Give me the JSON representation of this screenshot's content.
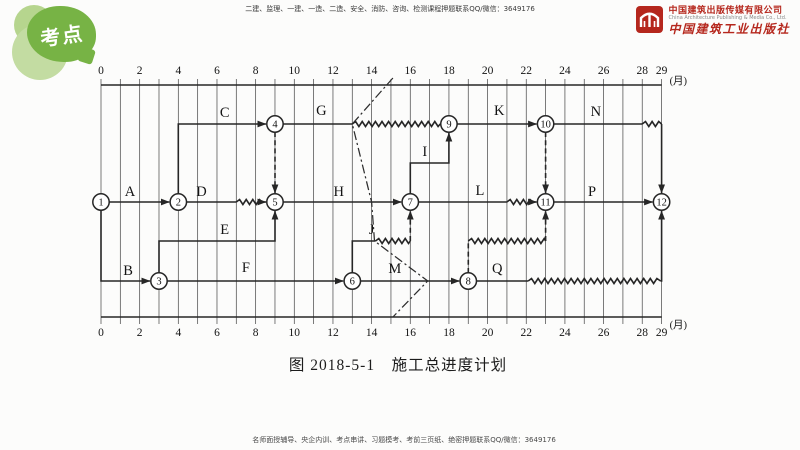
{
  "badge": {
    "text": "考点",
    "color": "#77b345",
    "light_color": "#b6d58e"
  },
  "header": {
    "promo_text": "二建、监理、一建、一造、二造、安全、消防、咨询、检测课程押题联系QQ/微信：3649176"
  },
  "publisher": {
    "name_cn": "中国建筑出版传媒有限公司",
    "name_en": "China Architecture Publishing & Media Co., Ltd.",
    "imprint": "中国建筑工业出版社",
    "brand_color": "#b5271d"
  },
  "footer": {
    "promo_text": "名师面授辅导、央企内训、考点串讲、习题模考、考前三页纸、绝密押题联系QQ/微信：3649176"
  },
  "caption": "图 2018-5-1　施工总进度计划",
  "diagram": {
    "unit_label": "(月)",
    "axis": {
      "months_start": 0,
      "months_end": 29,
      "ticks": [
        0,
        2,
        4,
        6,
        8,
        10,
        12,
        14,
        16,
        18,
        20,
        22,
        24,
        26,
        28,
        29
      ]
    },
    "x": {
      "left": 101,
      "step": 19.33
    },
    "rows": {
      "axis_top": 85,
      "top": 124,
      "i": 163,
      "main": 202,
      "float": 241,
      "bottom": 281,
      "axis_bottom": 317
    },
    "nodes": [
      {
        "n": "1",
        "m": 0,
        "row": "main"
      },
      {
        "n": "2",
        "m": 4,
        "row": "main"
      },
      {
        "n": "3",
        "m": 3,
        "row": "bottom"
      },
      {
        "n": "4",
        "m": 9,
        "row": "top"
      },
      {
        "n": "5",
        "m": 9,
        "row": "main"
      },
      {
        "n": "6",
        "m": 13,
        "row": "bottom"
      },
      {
        "n": "7",
        "m": 16,
        "row": "main"
      },
      {
        "n": "8",
        "m": 19,
        "row": "bottom"
      },
      {
        "n": "9",
        "m": 18,
        "row": "top"
      },
      {
        "n": "10",
        "m": 23,
        "row": "top"
      },
      {
        "n": "11",
        "m": 23,
        "row": "main"
      },
      {
        "n": "12",
        "m": 29,
        "row": "main"
      }
    ],
    "activities": [
      {
        "name": "A",
        "from": "1",
        "to": "2",
        "label": {
          "m": 1.5,
          "row": "main",
          "dy": -6
        },
        "segs": [
          {
            "s": "solid",
            "a": true,
            "p": [
              [
                0,
                "main",
                8,
                0
              ],
              [
                4,
                "main",
                -9,
                0
              ]
            ]
          }
        ]
      },
      {
        "name": "B",
        "from": "1",
        "to": "3",
        "label": {
          "m": 1.4,
          "row": "bottom",
          "dy": -6
        },
        "segs": [
          {
            "s": "solid",
            "a": true,
            "p": [
              [
                0,
                "main",
                0,
                8
              ],
              [
                0,
                "bottom"
              ],
              [
                3,
                "bottom",
                -9,
                0
              ]
            ]
          }
        ]
      },
      {
        "name": "C",
        "from": "2",
        "to": "4",
        "label": {
          "m": 6.4,
          "row": "top",
          "dy": -7
        },
        "segs": [
          {
            "s": "solid",
            "a": true,
            "p": [
              [
                4,
                "main",
                0,
                -8
              ],
              [
                4,
                "top"
              ],
              [
                9,
                "top",
                -9,
                0
              ]
            ]
          }
        ]
      },
      {
        "name": "D",
        "from": "2",
        "to": "5",
        "label": {
          "m": 5.2,
          "row": "main",
          "dy": -6
        },
        "segs": [
          {
            "s": "solid",
            "a": false,
            "p": [
              [
                4,
                "main",
                8,
                0
              ],
              [
                7,
                "main"
              ]
            ]
          },
          {
            "s": "wavy",
            "a": false,
            "p": [
              [
                7,
                "main"
              ],
              [
                8.35,
                "main"
              ]
            ]
          },
          {
            "s": "solid",
            "a": true,
            "p": [
              [
                8.35,
                "main"
              ],
              [
                9,
                "main",
                -9,
                0
              ]
            ]
          }
        ]
      },
      {
        "name": "E",
        "from": "3",
        "to": "5",
        "label": {
          "m": 6.4,
          "row": "float",
          "dy": -7
        },
        "segs": [
          {
            "s": "solid",
            "a": true,
            "p": [
              [
                3,
                "bottom",
                0,
                -8
              ],
              [
                3,
                "float"
              ],
              [
                9,
                "float"
              ],
              [
                9,
                "main",
                0,
                9
              ]
            ]
          }
        ]
      },
      {
        "name": "F",
        "from": "3",
        "to": "6",
        "label": {
          "m": 7.5,
          "row": "bottom",
          "dy": -9
        },
        "segs": [
          {
            "s": "solid",
            "a": true,
            "p": [
              [
                3,
                "bottom",
                8,
                0
              ],
              [
                13,
                "bottom",
                -9,
                0
              ]
            ]
          }
        ]
      },
      {
        "name": "G",
        "from": "4",
        "to": "9",
        "label": {
          "m": 11.4,
          "row": "top",
          "dy": -9
        },
        "segs": [
          {
            "s": "solid",
            "a": false,
            "p": [
              [
                9,
                "top",
                8,
                0
              ],
              [
                13,
                "top"
              ]
            ]
          },
          {
            "s": "wavy",
            "a": false,
            "p": [
              [
                13,
                "top"
              ],
              [
                17.55,
                "top"
              ]
            ]
          },
          {
            "s": "solid",
            "a": true,
            "p": [
              [
                17.55,
                "top"
              ],
              [
                18,
                "top",
                -9,
                0
              ]
            ]
          }
        ]
      },
      {
        "name": "H",
        "from": "5",
        "to": "7",
        "label": {
          "m": 12.3,
          "row": "main",
          "dy": -6
        },
        "segs": [
          {
            "s": "solid",
            "a": true,
            "p": [
              [
                9,
                "main",
                8,
                0
              ],
              [
                16,
                "main",
                -9,
                0
              ]
            ]
          }
        ]
      },
      {
        "name": "I",
        "from": "7",
        "to": "9",
        "label": {
          "m": 16.75,
          "row": "i",
          "dy": -7
        },
        "segs": [
          {
            "s": "solid",
            "a": true,
            "p": [
              [
                16,
                "main",
                0,
                -8
              ],
              [
                16,
                "i"
              ],
              [
                18,
                "i"
              ],
              [
                18,
                "top",
                0,
                9
              ]
            ]
          }
        ]
      },
      {
        "name": "J",
        "from": "6",
        "to": "7",
        "label": {
          "m": 14.0,
          "row": "float",
          "dy": -7
        },
        "segs": [
          {
            "s": "solid",
            "a": false,
            "p": [
              [
                13,
                "bottom",
                0,
                -8
              ],
              [
                13,
                "float"
              ],
              [
                14.2,
                "float"
              ]
            ]
          },
          {
            "s": "wavy",
            "a": false,
            "p": [
              [
                14.2,
                "float"
              ],
              [
                16,
                "float"
              ]
            ]
          },
          {
            "s": "dashed",
            "a": true,
            "p": [
              [
                16,
                "float"
              ],
              [
                16,
                "main",
                0,
                9
              ]
            ]
          }
        ]
      },
      {
        "name": "K",
        "from": "9",
        "to": "10",
        "label": {
          "m": 20.6,
          "row": "top",
          "dy": -9
        },
        "segs": [
          {
            "s": "solid",
            "a": true,
            "p": [
              [
                18,
                "top",
                8,
                0
              ],
              [
                23,
                "top",
                -9,
                0
              ]
            ]
          }
        ]
      },
      {
        "name": "L",
        "from": "7",
        "to": "11",
        "label": {
          "m": 19.6,
          "row": "main",
          "dy": -7
        },
        "segs": [
          {
            "s": "solid",
            "a": false,
            "p": [
              [
                16,
                "main",
                8,
                0
              ],
              [
                21,
                "main"
              ]
            ]
          },
          {
            "s": "wavy",
            "a": false,
            "p": [
              [
                21,
                "main"
              ],
              [
                22.35,
                "main"
              ]
            ]
          },
          {
            "s": "solid",
            "a": true,
            "p": [
              [
                22.35,
                "main"
              ],
              [
                23,
                "main",
                -9,
                0
              ]
            ]
          }
        ]
      },
      {
        "name": "M",
        "from": "6",
        "to": "8",
        "label": {
          "m": 15.2,
          "row": "bottom",
          "dy": -8
        },
        "segs": [
          {
            "s": "solid",
            "a": true,
            "p": [
              [
                13,
                "bottom",
                8,
                0
              ],
              [
                19,
                "bottom",
                -9,
                0
              ]
            ]
          }
        ]
      },
      {
        "name": "N",
        "from": "10",
        "to": "12",
        "label": {
          "m": 25.6,
          "row": "top",
          "dy": -8
        },
        "segs": [
          {
            "s": "solid",
            "a": false,
            "p": [
              [
                23,
                "top",
                8,
                0
              ],
              [
                28,
                "top"
              ]
            ]
          },
          {
            "s": "wavy",
            "a": false,
            "p": [
              [
                28,
                "top"
              ],
              [
                29,
                "top"
              ]
            ]
          },
          {
            "s": "solid",
            "a": true,
            "p": [
              [
                29,
                "top"
              ],
              [
                29,
                "main",
                0,
                -9
              ]
            ]
          }
        ]
      },
      {
        "name": "P",
        "from": "11",
        "to": "12",
        "label": {
          "m": 25.4,
          "row": "main",
          "dy": -6
        },
        "segs": [
          {
            "s": "solid",
            "a": true,
            "p": [
              [
                23,
                "main",
                8,
                0
              ],
              [
                29,
                "main",
                -9,
                0
              ]
            ]
          }
        ]
      },
      {
        "name": "Q",
        "from": "8",
        "to": "12",
        "label": {
          "m": 20.5,
          "row": "bottom",
          "dy": -8
        },
        "segs": [
          {
            "s": "solid",
            "a": false,
            "p": [
              [
                19,
                "bottom",
                8,
                0
              ],
              [
                22.1,
                "bottom"
              ]
            ]
          },
          {
            "s": "wavy",
            "a": false,
            "p": [
              [
                22.1,
                "bottom"
              ],
              [
                28.95,
                "bottom"
              ]
            ]
          },
          {
            "s": "solid",
            "a": true,
            "p": [
              [
                28.95,
                "bottom"
              ],
              [
                29,
                "bottom"
              ],
              [
                29,
                "main",
                0,
                9
              ]
            ]
          }
        ]
      }
    ],
    "dummies": [
      {
        "from": "4",
        "to": "5",
        "segs": [
          {
            "s": "dashed",
            "a": true,
            "p": [
              [
                9,
                "top",
                0,
                8
              ],
              [
                9,
                "main",
                0,
                -9
              ]
            ]
          }
        ]
      },
      {
        "from": "10",
        "to": "11",
        "segs": [
          {
            "s": "dashed",
            "a": true,
            "p": [
              [
                23,
                "top",
                0,
                8
              ],
              [
                23,
                "main",
                0,
                -9
              ]
            ]
          }
        ]
      },
      {
        "from": "8",
        "to": "11",
        "segs": [
          {
            "s": "dashed",
            "a": false,
            "p": [
              [
                19,
                "bottom",
                0,
                -8
              ],
              [
                19,
                "float"
              ]
            ]
          },
          {
            "s": "wavy",
            "a": false,
            "p": [
              [
                19,
                "float"
              ],
              [
                23,
                "float"
              ]
            ]
          },
          {
            "s": "dashed",
            "a": true,
            "p": [
              [
                23,
                "float"
              ],
              [
                23,
                "main",
                0,
                9
              ]
            ]
          }
        ]
      }
    ],
    "front_line": {
      "style": "dashdot",
      "p": [
        [
          15.1,
          "axis_top",
          0,
          -7
        ],
        [
          13,
          "top"
        ],
        [
          14,
          "main"
        ],
        [
          14.15,
          "float"
        ],
        [
          16.9,
          "bottom"
        ],
        [
          15.1,
          "axis_bottom"
        ]
      ]
    }
  }
}
